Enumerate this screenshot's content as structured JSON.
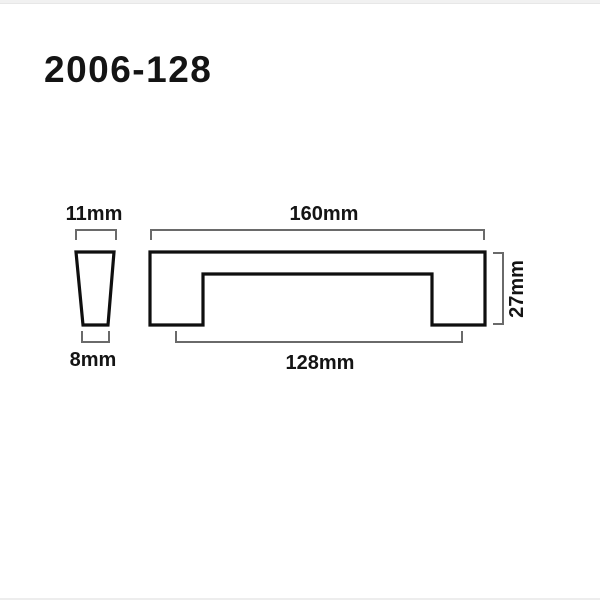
{
  "title": "2006-128",
  "views": {
    "side_profile": {
      "top_width_dim": "11mm",
      "bottom_width_dim": "8mm"
    },
    "front": {
      "overall_width_dim": "160mm",
      "hole_centers_dim": "128mm",
      "height_dim": "27mm"
    }
  },
  "colors": {
    "outline": "#0f0f0f",
    "dimension_line": "#6a6a6a",
    "text": "#141414",
    "background": "#ffffff",
    "page_edge_strip": "#f1f1f1"
  }
}
